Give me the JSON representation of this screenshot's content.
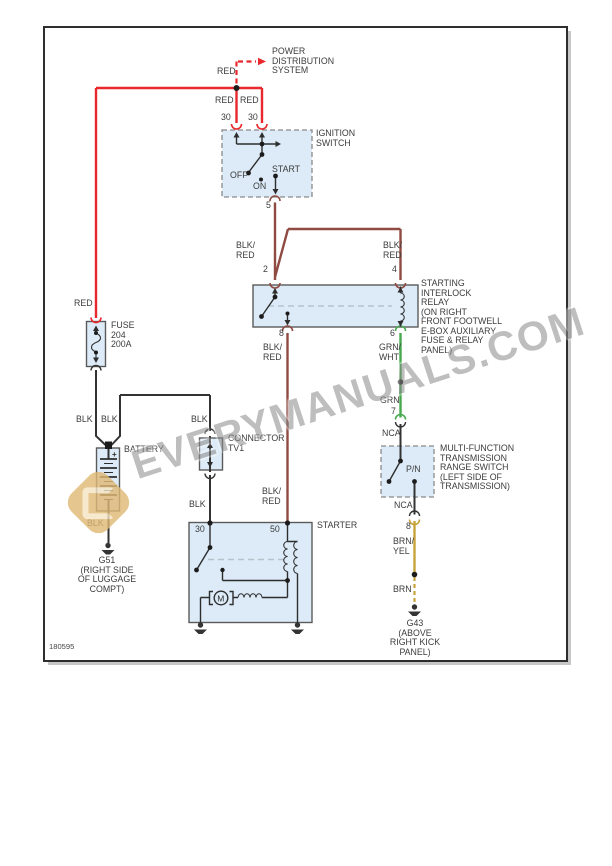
{
  "page": {
    "doc_number": "180595"
  },
  "watermark": {
    "text": "EVERYMANUALS.COM"
  },
  "colors": {
    "red": "#e8282c",
    "blk_red": "#8f4a42",
    "black": "#333333",
    "green": "#46a94e",
    "gold": "#c7a43b",
    "box_fill": "#dcebf7",
    "dash": "#b5c3cd",
    "text": "#3c3c3c",
    "watermark": "#8a8a8a",
    "logo": "#e0b974"
  },
  "texts": {
    "power_distribution": "POWER\nDISTRIBUTION\nSYSTEM",
    "red_feed": "RED",
    "red_30a": "RED",
    "red_30b": "RED",
    "pin30a": "30",
    "pin30b": "30",
    "ignition_switch": "IGNITION\nSWITCH",
    "off": "OFF",
    "on": "ON",
    "start": "START",
    "pin5": "5",
    "blkred_pin2": "BLK/\nRED",
    "blkred_pin4": "BLK/\nRED",
    "pin2": "2",
    "pin4": "4",
    "relay_name": "STARTING\nINTERLOCK\nRELAY\n(ON RIGHT\nFRONT FOOTWELL\nE-BOX AUXILIARY\nFUSE & RELAY\nPANEL)",
    "pin8_relay": "8",
    "pin6": "6",
    "blkred_pin50": "BLK/\nRED",
    "grn_wht": "GRN/\nWHT",
    "grn": "GRN",
    "pin7": "7",
    "nca_top": "NCA",
    "mft_name": "MULTI-FUNCTION\nTRANSMISSION\nRANGE SWITCH\n(LEFT SIDE OF\nTRANSMISSION)",
    "pn": "P/N",
    "nca_bottom": "NCA",
    "pin8_mft": "8",
    "brn_yel": "BRN/\nYEL",
    "brn": "BRN",
    "g43": "G43\n(ABOVE\nRIGHT KICK\nPANEL)",
    "red_fuse": "RED",
    "fuse_name": "FUSE\n204\n200A",
    "blk_fuse": "BLK",
    "blk_batt": "BLK",
    "blk_branch": "BLK",
    "battery": "BATTERY",
    "battery_plus": "+",
    "blk_gnd": "BLK",
    "g51": "G51\n(RIGHT SIDE\nOF LUGGAGE\nCOMPT)",
    "connector_name": "CONNECTOR\nTV1",
    "blk_conn_low": "BLK",
    "blkred_starter": "BLK/\nRED",
    "starter": "STARTER",
    "pin30_starter": "30",
    "pin50_starter": "50",
    "motor_m": "M"
  }
}
